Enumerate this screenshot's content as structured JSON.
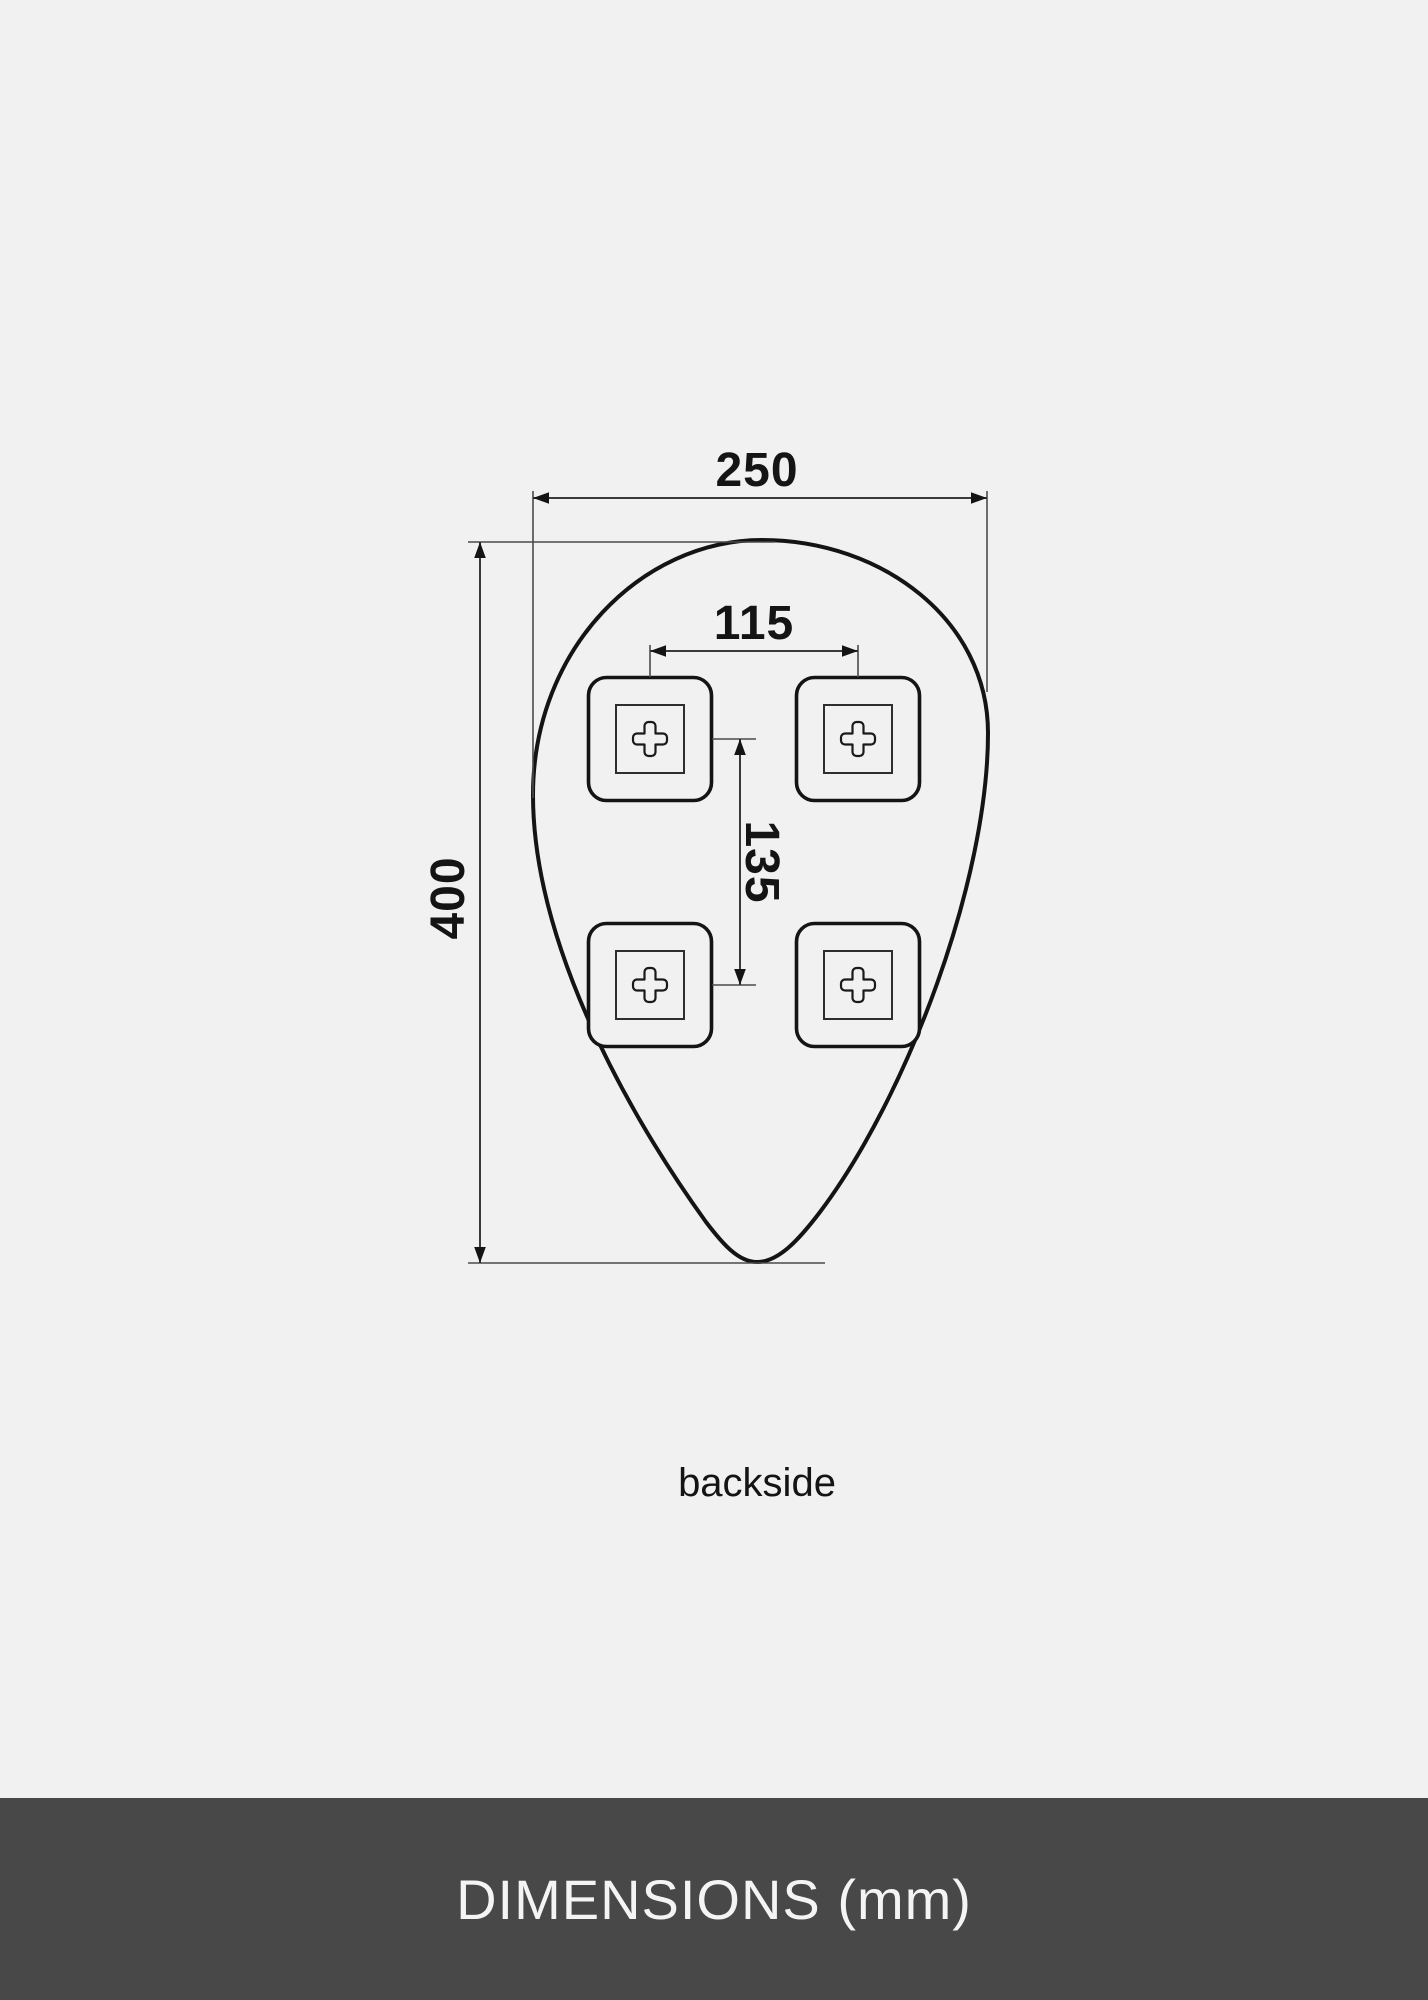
{
  "page": {
    "background_color": "#f1f1f1",
    "line_color": "#141414"
  },
  "diagram": {
    "view_label": "backside",
    "bracket_count": 4,
    "labels": {
      "overall_width": "250",
      "overall_height": "400",
      "bracket_spacing_horizontal": "115",
      "bracket_spacing_vertical": "135"
    }
  },
  "footer": {
    "title": "DIMENSIONS (mm)",
    "background_color": "#484848",
    "text_color": "#f4f4f4"
  }
}
